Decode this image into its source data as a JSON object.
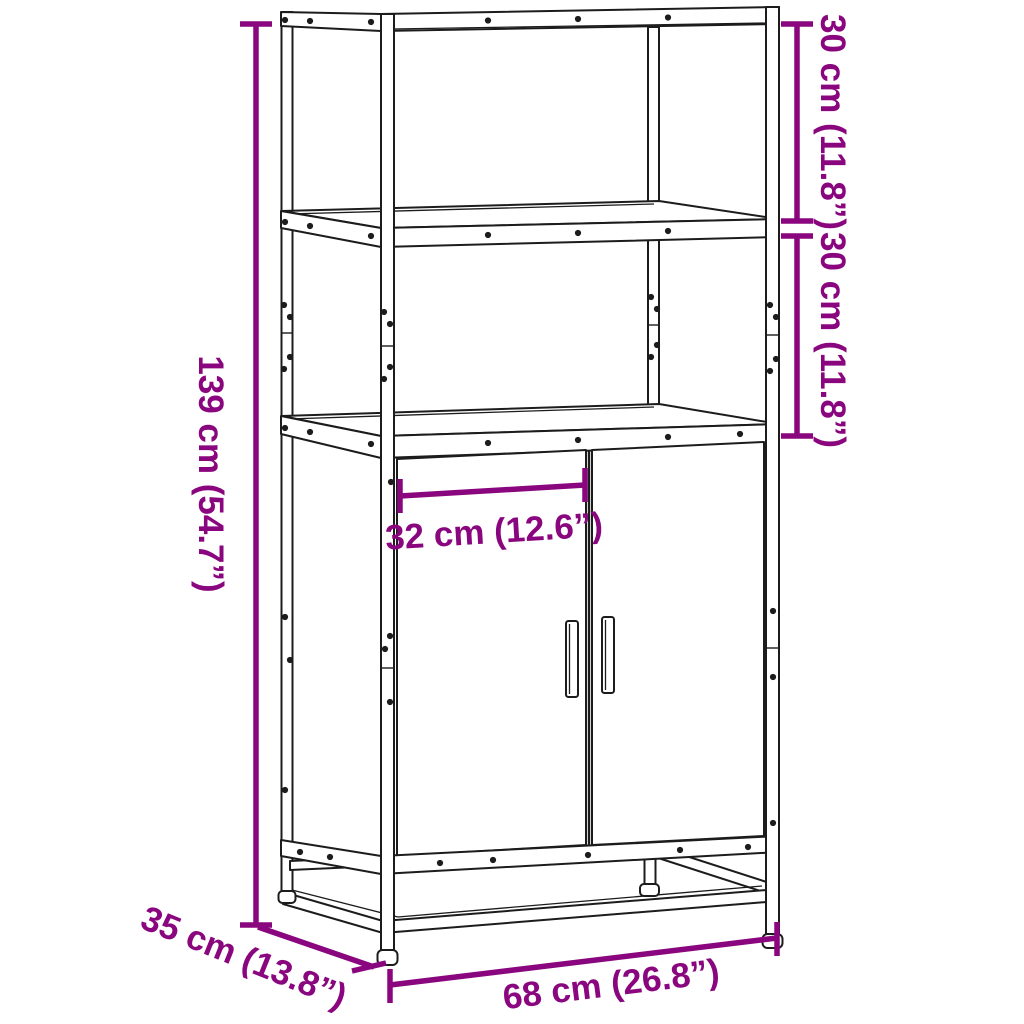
{
  "diagram": {
    "title": "Highboard dimension diagram",
    "product": "Highboard with two open shelves, two-door cabinet and metal frame",
    "view": "three-quarter front perspective line drawing",
    "colors": {
      "accent": "#8A067E",
      "line": "#1C1C1C",
      "background": "#FFFFFF"
    },
    "dimensions": [
      {
        "name": "overall-height",
        "label": "139 cm (54.7”)",
        "orientation": "vertical-left"
      },
      {
        "name": "upper-shelf-height",
        "label": "30 cm (11.8”)",
        "orientation": "vertical-right-top"
      },
      {
        "name": "lower-shelf-height",
        "label": "30 cm (11.8”)",
        "orientation": "vertical-right-middle"
      },
      {
        "name": "door-width",
        "label": "32 cm (12.6”)",
        "orientation": "horizontal-middle"
      },
      {
        "name": "depth",
        "label": "35 cm (13.8”)",
        "orientation": "diagonal-bottom-left"
      },
      {
        "name": "overall-width",
        "label": "68 cm (26.8”)",
        "orientation": "horizontal-bottom"
      }
    ]
  }
}
